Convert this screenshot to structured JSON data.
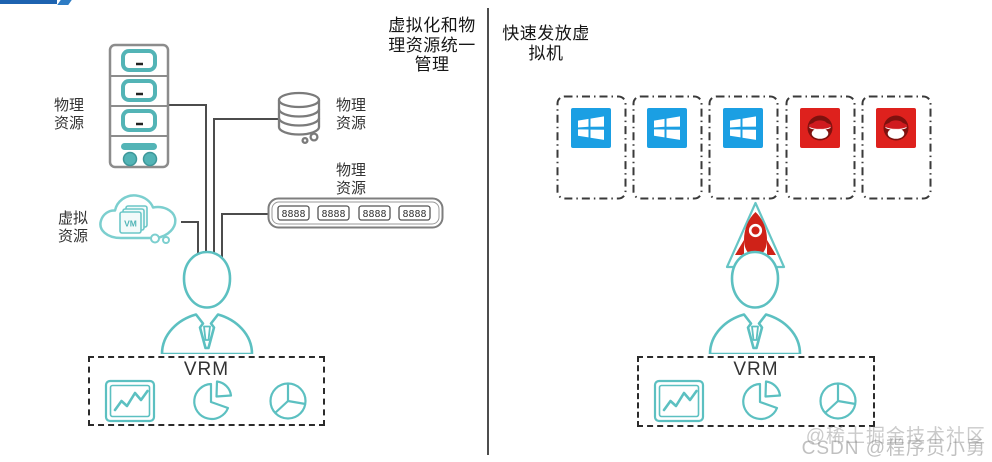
{
  "left_panel": {
    "title": "虚拟化和物理资源统一管理",
    "server_label": "物理资源",
    "storage_label": "物理资源",
    "switch_label": "物理资源",
    "virtual_label": "虚拟资源",
    "cloud_vm_text": "VM",
    "switch_ports_text": "8888",
    "vrm_label": "VRM"
  },
  "right_panel": {
    "title": "快速发放虚拟机",
    "vm_boxes": [
      "windows",
      "windows",
      "windows",
      "redhat",
      "redhat"
    ],
    "vrm_label": "VRM"
  },
  "watermark": {
    "line1": "@稀土掘金技术社区",
    "line2": "CSDN @程序员小勇"
  },
  "colors": {
    "teal": "#5cc0c1",
    "cloud_teal": "#7ccfcf",
    "line_gray": "#4c4c4c",
    "outline_gray": "#7e7e7e",
    "windows_blue": "#1b9fe3",
    "redhat_red": "#de211d",
    "rocket_red": "#cf2218",
    "topbar_blue": "#1d63b0"
  }
}
